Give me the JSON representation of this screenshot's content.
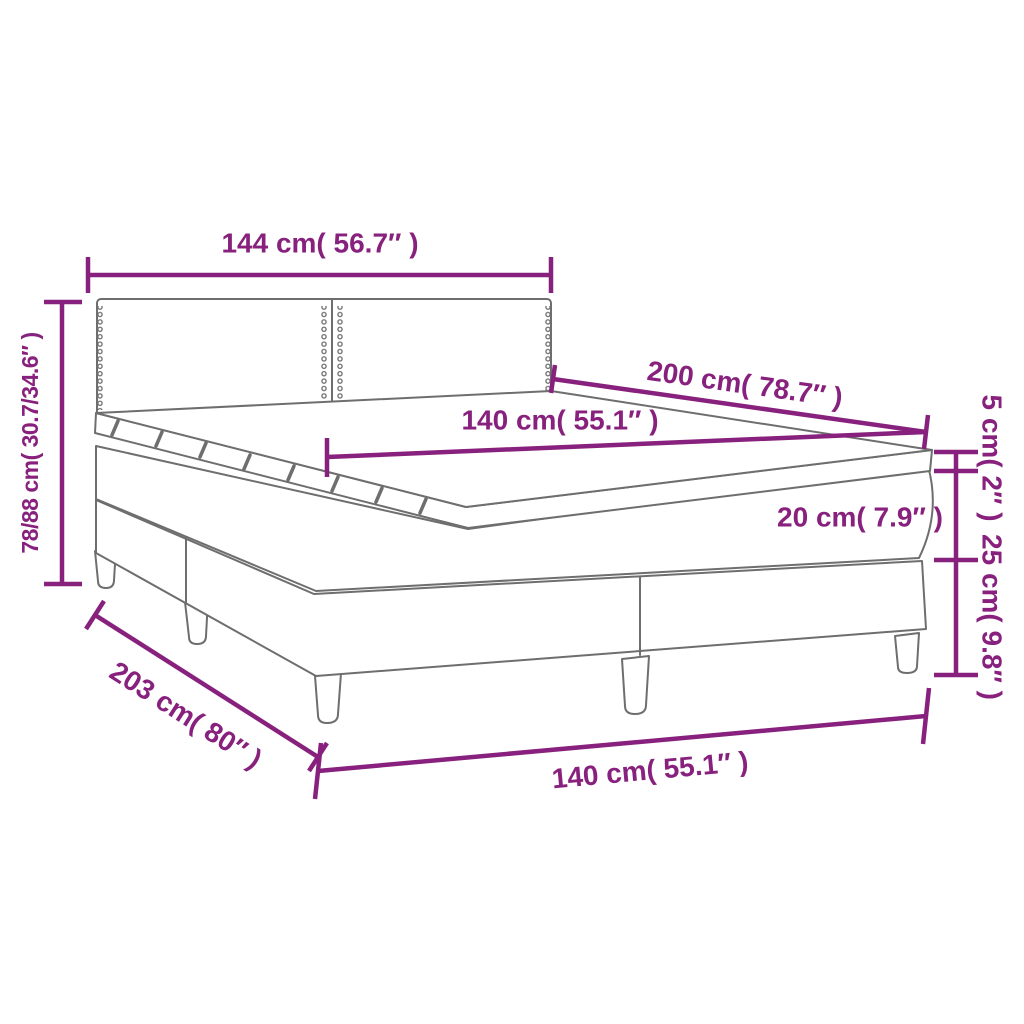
{
  "diagram": {
    "name": "box-spring-bed-dimension-diagram",
    "colors": {
      "dimension_accent": "#88217D",
      "outline_gray": "#6E6E6E",
      "background": "#FFFFFF"
    },
    "labels": {
      "headboard_width": "144 cm( 56.7″ )",
      "total_height": "78/88 cm( 30.7/34.6″ )",
      "bed_length": "200 cm( 78.7″ )",
      "mattress_width_top": "140 cm( 55.1″ )",
      "topper_thickness": "5 cm( 2″ )",
      "mattress_thickness": "20 cm( 7.9″ )",
      "base_height": "25 cm( 9.8″ )",
      "total_length": "203 cm( 80″ )",
      "mattress_width_bottom": "140 cm( 55.1″ )"
    }
  }
}
